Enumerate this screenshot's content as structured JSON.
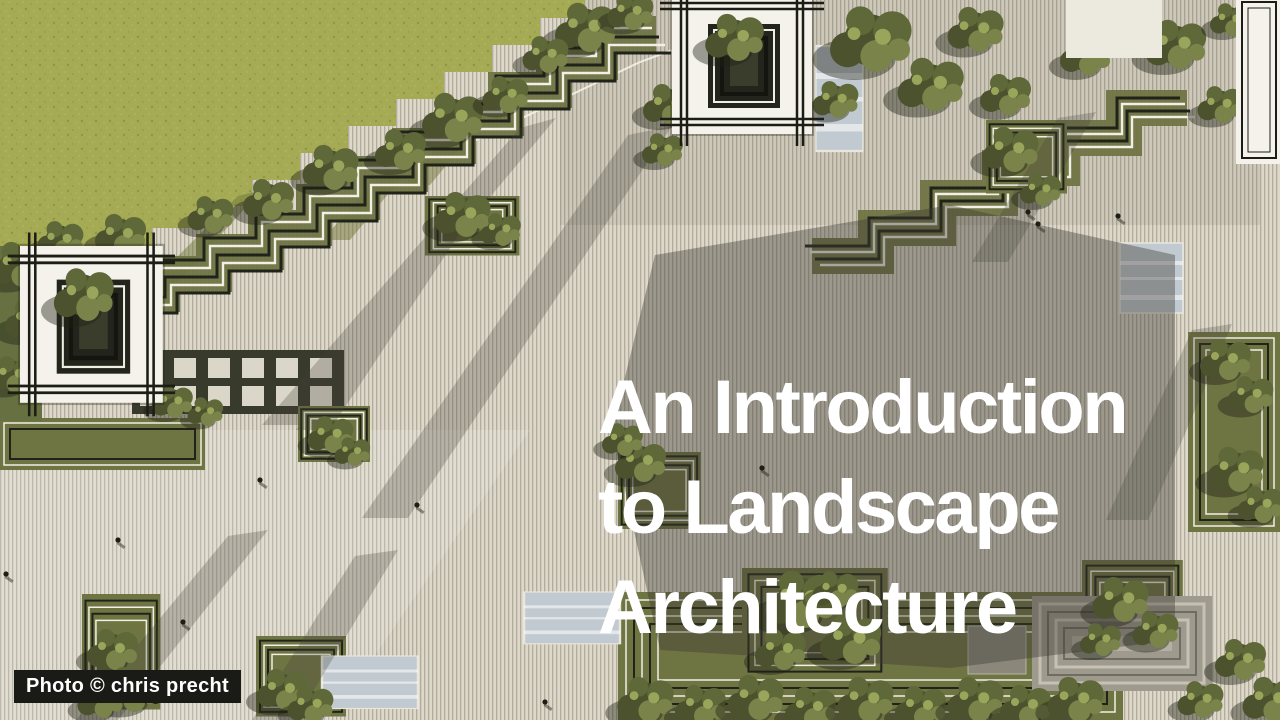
{
  "title": {
    "line1": "An Introduction",
    "line2": "to Landscape",
    "line3": "Architecture"
  },
  "credit": {
    "label": "Photo © chris precht"
  },
  "scene": {
    "alt": "Aerial rendering of a terraced landscape plaza with striped decking, stepped garden contours, square tree planters, nested-square pavilions and small pedestrians",
    "palette": {
      "grass": "#a5aa54",
      "deck_light": "#ddd8ca",
      "deck_line": "#b3ac9c",
      "tree_dark": "#4c522d",
      "tree_mid": "#5f6838",
      "tree_light": "#79834a",
      "tree_pale": "#9aa55c",
      "garden_olive": "#6f7443",
      "contour_dark": "#20231a",
      "contour_light": "#f2efe4",
      "pool": "#c2cad1",
      "roof_white": "#f4f2ea",
      "title_color": "#ffffff",
      "credit_bg": "#1a1a16",
      "credit_color": "#ffffff"
    }
  }
}
